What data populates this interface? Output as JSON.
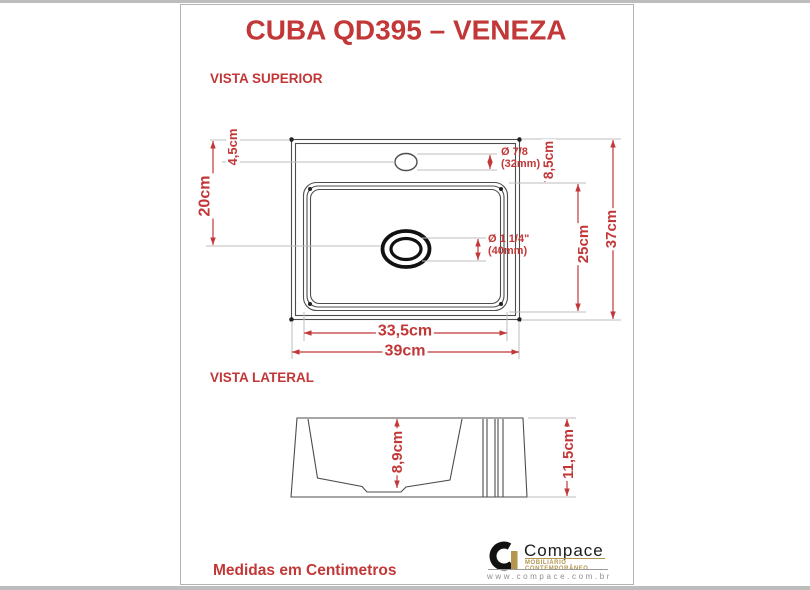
{
  "title": "CUBA QD395 – VENEZA",
  "sections": {
    "top_view": "VISTA SUPERIOR",
    "side_view": "VISTA LATERAL"
  },
  "footer_note": "Medidas em Centimetros",
  "colors": {
    "accent_red": "#c23737",
    "line_dark": "#4d4d4d",
    "line_light": "#bdbdbd",
    "gold": "#b3954e",
    "bar_grey": "#bdbdbd",
    "border_grey": "#b3b3b3"
  },
  "top_view": {
    "dims": {
      "top_to_faucet": "4,5cm",
      "top_to_drain": "20cm",
      "back_rim": "8,5cm",
      "basin_length": "25cm",
      "total_depth": "37cm",
      "basin_width": "33,5cm",
      "total_width": "39cm"
    },
    "faucet_hole": {
      "line1": "Ø 7/8",
      "line2": "(32mm)"
    },
    "drain": {
      "line1": "Ø 1 1/4\"",
      "line2": "(40mm)"
    }
  },
  "side_view": {
    "dims": {
      "inner_height": "8,9cm",
      "total_height": "11,5cm"
    }
  },
  "logo": {
    "brand": "Compace",
    "tagline": "MOBILIÁRIO CONTEMPORÂNEO",
    "website": "www.compace.com.br"
  }
}
